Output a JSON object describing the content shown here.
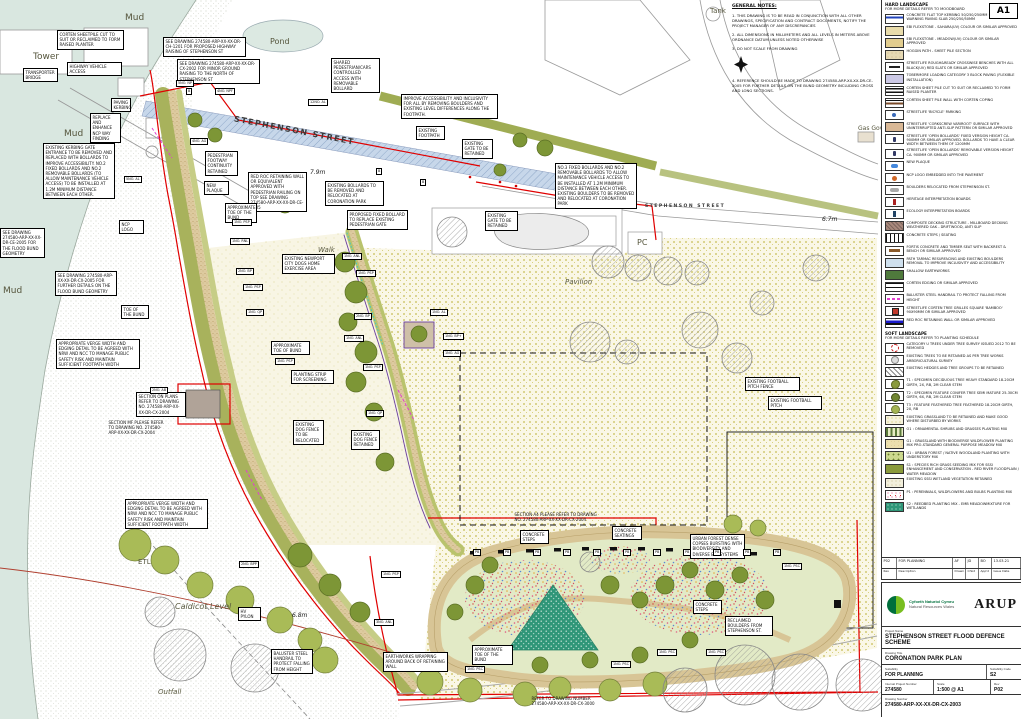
{
  "sheet": {
    "size_tag": "A1"
  },
  "general_notes": {
    "title": "GENERAL NOTES:",
    "items": [
      "1. THIS DRAWING IS TO BE READ IN CONJUNCTION WITH ALL OTHER DRAWINGS, SPECIFICATION AND CONTRACT DOCUMENTS, NOTIFY THE PROJECT MANAGER OF ANY DISCREPANCIES",
      "2. ALL DIMENSIONS IN MILLIMETERS AND ALL LEVELS IN METERS ABOVE ORDNANCE DATUM UNLESS NOTED OTHERWISE",
      "3. DO NOT SCALE FROM DRAWING",
      "4. REFERENCE SHOULD BE MADE TO DRAWING 274580-ARP-XX-XX-DR-CE-2005 FOR FURTHER DETAILS ON THE BUND GEOMETRY INCLUDING CROSS AND LONG SECTIONS."
    ]
  },
  "legend": {
    "hard": {
      "title": "HARD LANDSCAPE",
      "subtitle": "FOR MORE DETAILS REFER TO MOODBOARD",
      "items": [
        {
          "sw": "kerb",
          "label": "CONCRETE FLAT TOP KERBING 50/250/250mm + HAZARD WARNING PAVING SLAB 250/250/50mm"
        },
        {
          "sw": "sahara",
          "label": "EBI FLEXSTONE - SAHARA(UV) COLOUR OR SIMILAR APPROVED"
        },
        {
          "sw": "meadow",
          "label": "EBI FLEXSTONE - MEADOW(UV) COLOUR OR SIMILAR APPROVED"
        },
        {
          "sw": "hoggin",
          "label": "HOGGIN PATH - SHEET PILE SECTION"
        },
        {
          "sw": "bench",
          "label": "STREETLIFE ROUGH&READY CROSSWISE BENCHES WITH ALL BLACK(UV) RED SLATS OR SIMILAR APPROVED"
        },
        {
          "sw": "block-paving",
          "label": "TOBERMORE LOADING CATEGORY 3 BLOCK PAVING (FLEXIBLE INSTALLATION)"
        },
        {
          "sw": "corten-cut",
          "label": "CORTEN SHEET PILE CUT TO SUIT OR RECLAIMED TO FORM RAISED PLANTER"
        },
        {
          "sw": "corten-wall",
          "label": "CORTEN SHEET PILE WALL WITH CORTEN COPING"
        },
        {
          "sw": "bike",
          "label": "STREETLIFE 'BICYCLE' PARKING"
        },
        {
          "sw": "varicoot",
          "label": "STREETLIFE 'CORKSCREW VARIROOT' SURFACE WITH UNINTERRUPTED ANTI-SLIP PATTERN OR SIMILAR APPROVED"
        },
        {
          "sw": "bollard-fixed",
          "label": "STREETLIFE 'OPEN BOLLARDS' FIXED VERSION HEIGHT CA. 900MM OR SIMILAR APPROVED. BOLLARDS TO HAVE A CLEAR WIDTH BETWEEN THEM OF 1200MM"
        },
        {
          "sw": "bollard-removable",
          "label": "STREETLIFE 'OPEN BOLLARDS' REMOVABLE VERSION HEIGHT CA. 900MM OR SIMILAR APPROVED"
        },
        {
          "sw": "plaque",
          "label": "NEW PLAQUE"
        },
        {
          "sw": "ncp",
          "label": "NCP LOGO EMBEDDED INTO THE PAVEMENT"
        },
        {
          "sw": "boulders",
          "label": "BOULDERS RELOCATED FROM STEPHENSON ST."
        },
        {
          "sw": "heritage",
          "label": "HERITAGE INTERPRETATION BOARDS"
        },
        {
          "sw": "ecology",
          "label": "ECOLOGY INTERPRETATION BOARDS"
        },
        {
          "sw": "decking",
          "label": "COMPOSITE DECKING STRUCTURE - MILLBOARD DECKING WEATHERED OAK - DRIFTWOOD, ANTI SLIP"
        },
        {
          "sw": "steps",
          "label": "CONCRETE STEPS / SEATING"
        },
        {
          "sw": "fortis",
          "label": "FORTIS CONCRETE AND TIMBER SEAT WITH BACKREST & BENCH OR SIMILAR APPROVED"
        },
        {
          "sw": "tarmac",
          "label": "PATH TARMAC RESURFACING AND EXISTING BOULDERS REMOVAL TO IMPROVE INCLUSIVITY AND ACCESSIBILITY"
        },
        {
          "sw": "earthworks",
          "label": "SHALLOW EARTHWORKS"
        },
        {
          "sw": "corten-edge",
          "label": "CORTEN EDGING OR SIMILAR APPROVED"
        },
        {
          "sw": "handrail",
          "label": "BALUSTER STEEL HANDRAIL TO PROTECT FALLING FROM HEIGHT"
        },
        {
          "sw": "tree-grille",
          "label": "STREETLIFE CORTEN TREE GRILLES SQUARE 'BAMBOO' 90X90MM OR SIMILAR APPROVED"
        },
        {
          "sw": "redroc",
          "label": "RED ROC RETAINING WALL OR SIMILAR APPROVED"
        }
      ]
    },
    "soft": {
      "title": "SOFT LANDSCAPE",
      "subtitle": "FOR MORE DETAILS REFER TO PLANTING SCHEDULE",
      "items": [
        {
          "sw": "cat-u",
          "label": "CATEGORY U TREES UNDER TREE SURVEY ISSUED 2012 TO BE REMOVED"
        },
        {
          "sw": "exist-tree",
          "label": "EXISTING TREES TO BE RETAINED AS PER TREE WORKS ARBORICULTURAL SURVEY"
        },
        {
          "sw": "hedges",
          "label": "EXISTING HEDGES AND TREE GROUPS TO BE RETAINED"
        },
        {
          "sw": "t1",
          "label": "T1 : SPECIMEN DECIDUOUS TREE HEAVY STANDARD 18-20CM GIRTH, 2X, RB, 2M CLEAR STEM"
        },
        {
          "sw": "t2",
          "label": "T2 : SPECIMEN FEATURE CONIFER TREE SEMI MATURE 25-30CM GIRTH, 6X, RB, 2M CLEAR STEM"
        },
        {
          "sw": "t3",
          "label": "T3 : FEATURE FEATHERED TREE FEATHERED 18-20CM GIRTH, 2X, RB"
        },
        {
          "sw": "grass-exist",
          "label": "EXISTING GRASSLAND TO BE RETAINED AND MAKE GOOD WHERE DISTURBED BY WORKS"
        },
        {
          "sw": "o1",
          "label": "O1 : ORNAMENTAL SHRUBS AND GRASSES PLANTING MIX"
        },
        {
          "sw": "g1",
          "label": "G1 : GRASSLAND WITH BIODIVERSE WILDFLOWER PLANTING MIX PRO-STANDARD GENERAL PURPOSE MEADOW MIX"
        },
        {
          "sw": "u1",
          "label": "U1 : URBAN FOREST / NATIVE WOODLAND PLANTING WITH UNDERSTORY MIX"
        },
        {
          "sw": "s1",
          "label": "S1 : SPECIES RICH GRASS SEEDING MIX FOR SSSI ENHANCEMENT AND CONSERVATION - RED RIVER FLOODPLAIN / WATER MEADOW"
        },
        {
          "sw": "sssi",
          "label": "EXISTING SSSI WETLAND VEGETATION RETAINED"
        },
        {
          "sw": "p1",
          "label": "P1 : PERENNIALS, WILDFLOWERS AND BULBS PLANTING MIX"
        },
        {
          "sw": "s2",
          "label": "S2 : REEDBED PLANTING MIX - EMB MEADOWMIXTURE FOR WETLANDS"
        }
      ]
    }
  },
  "revision_table": {
    "headers": [
      "Rev",
      "Description",
      "Drawn",
      "Chkd",
      "App'd",
      "Issue Date"
    ],
    "rows": [
      [
        "P02",
        "FOR PLANNING",
        "AF",
        "JD",
        "BO",
        "13.03.21"
      ]
    ]
  },
  "title_block": {
    "client_line1": "Cyfoeth Naturiol Cymru",
    "client_line2": "Natural Resources Wales",
    "consultant": "ARUP",
    "project_name_label": "Project Name",
    "project_name": "STEPHENSON STREET FLOOD DEFENCE SCHEME",
    "drawing_title_label": "Drawing Title",
    "drawing_title": "CORONATION PARK PLAN",
    "suitability_label": "Suitability",
    "suitability": "FOR PLANNING",
    "suitability_code_label": "Suitability Code",
    "suitability_code": "S2",
    "project_number_label": "Internal Project Number",
    "project_number": "274580",
    "scale_label": "Scale",
    "scale": "1:500 @ A1",
    "rev_label": "Rev",
    "rev": "P02",
    "drawing_number_label": "Drawing Number",
    "drawing_number": "274580-ARP-XX-XX-DR-CX-2003"
  },
  "map": {
    "annotations": [
      {
        "t": "CORTEN SHEETPILE CUT TO SUIT OR RECLAIMED TO FORM RAISED PLANTER",
        "x": 57,
        "y": 30,
        "w": 62
      },
      {
        "t": "SEE DRAWING 274580-ARP-XX-XX-DR-CH-1201 FOR PROPOSED HIGHWAY RAISING OF STEPHENSON ST",
        "x": 163,
        "y": 37,
        "w": 78
      },
      {
        "t": "SEE DRAWING 274580-ARP-XX-XX-DR-CX-2002 FOR MINOR GROUND RAISING TO THE NORTH OF STEPHENSON ST",
        "x": 177,
        "y": 59,
        "w": 78
      },
      {
        "t": "SHARED PEDESTRIAN/CARS CONTROLLED ACCESS WITH REMOVABLE BOLLARD",
        "x": 331,
        "y": 58,
        "w": 44
      },
      {
        "t": "HIGHWAY VEHICLE ACCESS",
        "x": 67,
        "y": 62,
        "w": 50
      },
      {
        "t": "TRANSPORTER BRIDGE",
        "x": 23,
        "y": 68,
        "w": 30
      },
      {
        "t": "PAVING KERBING",
        "x": 111,
        "y": 98,
        "w": 15
      },
      {
        "t": "REPLACE AND ENHANCE NCP WAY FINDING",
        "x": 90,
        "y": 113,
        "w": 26
      },
      {
        "t": "IMPROVE ACCESSIBILITY AND INCLUSIVITY FOR ALL BY REMOVING BOULDERS AND EXISTING LEVEL DIFFERENCES ALONG THE FOOTPATH.",
        "x": 401,
        "y": 94,
        "w": 92
      },
      {
        "t": "EXISTING KERBING GATE ENTRANCE TO BE REMOVED AND REPLACED WITH BOLLARDS TO IMPROVE ACCESSIBILITY. NO.2 FIXED BOLLARDS AND NO.2 REMOVABLE BOLLARDS (TO ALLOW MAINTENANCE VEHICLE ACCESS) TO BE INSTALLED AT 1.2M MINIMUM DISTANCE BETWEEN EACH OTHER.",
        "x": 43,
        "y": 143,
        "w": 67
      },
      {
        "t": "RED ROC RETAINING WALL OR EQUIVALENT APPROVED WITH PEDESTRIAN RAILING ON TOP SEE DRAWING 274580-ARP-XX-XX-DR-CE-2005",
        "x": 248,
        "y": 172,
        "w": 54
      },
      {
        "t": "PEDESTRIAN FOOTWAY CONTINUITY RETAINED",
        "x": 205,
        "y": 151,
        "w": 28
      },
      {
        "t": "NEW PLAQUE",
        "x": 204,
        "y": 181,
        "w": 20
      },
      {
        "t": "EXISTING FOOTPATH",
        "x": 416,
        "y": 126,
        "w": 24
      },
      {
        "t": "EXISTING GATE TO BE RETAINED",
        "x": 462,
        "y": 139,
        "w": 26
      },
      {
        "t": "EXISTING BOLLARDS TO BE REMOVED AND RELOCATED AT CORONATION PARK",
        "x": 325,
        "y": 181,
        "w": 54
      },
      {
        "t": "PROPOSED FIXED BOLLARD TO REPLACE EXISTING PEDESTRIAN GATE",
        "x": 347,
        "y": 210,
        "w": 56
      },
      {
        "t": "NO.3 FIXED BOLLARDS AND NO.2 REMOVABLE BOLLARDS TO ALLOW MAINTENANCE VEHICLE ACCESS TO BE INSTALLED AT 1.2M MINIMUM DISTANCE BETWEEN EACH OTHER. EXISTING BOULDERS TO BE REMOVED AND RELOCATED AT CORONATION PARK",
        "x": 555,
        "y": 163,
        "w": 77
      },
      {
        "t": "EXISTING GATE TO BE RETAINED",
        "x": 485,
        "y": 211,
        "w": 28
      },
      {
        "t": "EXISTING NEWPORT CITY DOGS HOME EXERCISE AREA",
        "x": 282,
        "y": 254,
        "w": 48
      },
      {
        "t": "SEE DRAWING 274580-ARP-XX-XX-DR-CE-2005 FOR THE FLOOD BUND GEOMETRY",
        "x": 0,
        "y": 228,
        "w": 40
      },
      {
        "t": "SEE DRAWING 274580-ARP-XX-XX-DR-CX-2005 FOR FURTHER DETAILS ON THE FLOOD BUND GEOMETRY",
        "x": 55,
        "y": 271,
        "w": 57
      },
      {
        "t": "NCP LOGO",
        "x": 119,
        "y": 220,
        "w": 20
      },
      {
        "t": "APPROXIMATE TOE OF THE BUND",
        "x": 225,
        "y": 203,
        "w": 27
      },
      {
        "t": "TOE OF THE BUND",
        "x": 121,
        "y": 305,
        "w": 23
      },
      {
        "t": "APPROPRIATE VERGE WIDTH AND EDGING DETAIL TO BE AGREED WITH NRW AND NCC TO MANAGE PUBLIC SAFETY RISK AND MAINTAIN SUFFICIENT FOOTPATH WIDTH",
        "x": 56,
        "y": 339,
        "w": 79
      },
      {
        "t": "SECTION ON PLANS REFER TO DRAWING NO. 274580-ARP-XX-XX-DR-CX-2004",
        "x": 136,
        "y": 392,
        "w": 45
      },
      {
        "t": "EXISTING DOG FENCE TO BE RELOCATED",
        "x": 293,
        "y": 420,
        "w": 26
      },
      {
        "t": "EXISTING DOG FENCE RETAINED",
        "x": 351,
        "y": 430,
        "w": 24
      },
      {
        "t": "PLANTING STRIP FOR SCREENING",
        "x": 291,
        "y": 370,
        "w": 38
      },
      {
        "t": "APPROXIMATE TOE OF BUND",
        "x": 271,
        "y": 341,
        "w": 34
      },
      {
        "t": "SECTION MF PLEASE REFER TO DRAWING NO. 274580-ARP-XX-XX-DR-CX-2004",
        "x": 107,
        "y": 419,
        "w": 56,
        "plain": true
      },
      {
        "t": "APPROPRIATE VERGE WIDTH AND EDGING DETAIL TO BE AGREED WITH NRW AND NCC TO MANAGE PUBLIC SAFETY RISK AND MAINTAIN SUFFICIENT FOOTPATH WIDTH",
        "x": 125,
        "y": 499,
        "w": 78
      },
      {
        "t": "EXISTING FOOTBALL PITCH FENCE",
        "x": 745,
        "y": 377,
        "w": 50
      },
      {
        "t": "EXISTING FOOTBALL PITCH",
        "x": 768,
        "y": 396,
        "w": 49
      },
      {
        "t": "SECTION A4 PLEASE REFER TO DRAWING NO. 274580-ARP-XX-XX-DR-CX-2004",
        "x": 513,
        "y": 511,
        "w": 84,
        "plain": true
      },
      {
        "t": "CONCRETE STEPS",
        "x": 520,
        "y": 530,
        "w": 24
      },
      {
        "t": "CONCRETE SEATINGS",
        "x": 612,
        "y": 526,
        "w": 25
      },
      {
        "t": "URBAN FOREST DENSE COPSES BURSTING WITH BIODIVERSITY AND DIVERSE ECOSYSTEMS",
        "x": 690,
        "y": 534,
        "w": 50
      },
      {
        "t": "CONCRETE STEPS",
        "x": 693,
        "y": 600,
        "w": 24
      },
      {
        "t": "RECLAIMED BOULDERS FROM STEPHENSON ST.",
        "x": 725,
        "y": 616,
        "w": 43
      },
      {
        "t": "APPROXIMATE TOE OF THE BUND",
        "x": 472,
        "y": 645,
        "w": 36
      },
      {
        "t": "BALUSTER STEEL HANDRAIL TO PROTECT FALLING FROM HEIGHT",
        "x": 271,
        "y": 649,
        "w": 37
      },
      {
        "t": "EARTHWORKS WRAPPING AROUND BACK OF RETAINING WALL",
        "x": 383,
        "y": 652,
        "w": 60
      },
      {
        "t": "REFER TO DRAWING NUMBER 274580-ARP-XX-XX-DR-CX-3000",
        "x": 530,
        "y": 695,
        "w": 66,
        "plain": true
      },
      {
        "t": "HV PYLON",
        "x": 238,
        "y": 607,
        "w": 18
      }
    ],
    "tags": [
      {
        "t": "5NO. NP",
        "x": 176,
        "y": 80
      },
      {
        "t": "B",
        "x": 186,
        "y": 88
      },
      {
        "t": "4NO. NPF",
        "x": 215,
        "y": 88
      },
      {
        "t": "4NO. AG",
        "x": 190,
        "y": 138
      },
      {
        "t": "5NO. AL",
        "x": 124,
        "y": 176
      },
      {
        "t": "12NO. AL",
        "x": 308,
        "y": 99
      },
      {
        "t": "B",
        "x": 376,
        "y": 168
      },
      {
        "t": "B",
        "x": 420,
        "y": 179
      },
      {
        "t": "1NO. PSP",
        "x": 232,
        "y": 219
      },
      {
        "t": "1NO. RNL",
        "x": 230,
        "y": 238
      },
      {
        "t": "2NO. BP",
        "x": 236,
        "y": 268
      },
      {
        "t": "1NO. PSP",
        "x": 243,
        "y": 284
      },
      {
        "t": "1NO. QP",
        "x": 246,
        "y": 309
      },
      {
        "t": "1NO. PSP",
        "x": 275,
        "y": 358
      },
      {
        "t": "1NO. ANL",
        "x": 342,
        "y": 253
      },
      {
        "t": "1NO. PSP",
        "x": 356,
        "y": 270
      },
      {
        "t": "2NO. BP",
        "x": 354,
        "y": 313
      },
      {
        "t": "1NO. ANL",
        "x": 344,
        "y": 335
      },
      {
        "t": "1NO. AL",
        "x": 430,
        "y": 309
      },
      {
        "t": "1NO. BP+",
        "x": 443,
        "y": 333
      },
      {
        "t": "1NO. AG",
        "x": 443,
        "y": 350
      },
      {
        "t": "1NO. PSP",
        "x": 363,
        "y": 364
      },
      {
        "t": "1NO. QP",
        "x": 366,
        "y": 410
      },
      {
        "t": "2NO. AB",
        "x": 150,
        "y": 387
      },
      {
        "t": "2NO. BPP",
        "x": 239,
        "y": 561
      },
      {
        "t": "1NO. PSP",
        "x": 381,
        "y": 571
      },
      {
        "t": "3NO. ANL",
        "x": 374,
        "y": 619
      },
      {
        "t": "1NO. PSC",
        "x": 465,
        "y": 666
      },
      {
        "t": "1NO. PSC",
        "x": 611,
        "y": 661
      },
      {
        "t": "1NO. PSC",
        "x": 657,
        "y": 649
      },
      {
        "t": "1NO. PSC",
        "x": 706,
        "y": 649
      },
      {
        "t": "1NO. PSC",
        "x": 782,
        "y": 563
      },
      {
        "t": "PB",
        "x": 473,
        "y": 549
      },
      {
        "t": "PB",
        "x": 503,
        "y": 549
      },
      {
        "t": "PB",
        "x": 533,
        "y": 549
      },
      {
        "t": "PB",
        "x": 563,
        "y": 549
      },
      {
        "t": "PB",
        "x": 593,
        "y": 549
      },
      {
        "t": "PB",
        "x": 623,
        "y": 549
      },
      {
        "t": "PB",
        "x": 653,
        "y": 549
      },
      {
        "t": "PB",
        "x": 683,
        "y": 549
      },
      {
        "t": "PB",
        "x": 713,
        "y": 549
      },
      {
        "t": "PB",
        "x": 743,
        "y": 549
      },
      {
        "t": "PB",
        "x": 773,
        "y": 549
      }
    ],
    "labels": [
      {
        "t": "Tower",
        "x": 33,
        "y": 52,
        "fs": 9,
        "cls": ""
      },
      {
        "t": "Mud",
        "x": 125,
        "y": 13,
        "fs": 9,
        "cls": ""
      },
      {
        "t": "Mud",
        "x": 64,
        "y": 129,
        "fs": 9,
        "cls": ""
      },
      {
        "t": "Mud",
        "x": 3,
        "y": 286,
        "fs": 9,
        "cls": ""
      },
      {
        "t": "Pond",
        "x": 270,
        "y": 37,
        "fs": 8,
        "cls": ""
      },
      {
        "t": "Tank",
        "x": 710,
        "y": 7,
        "fs": 7,
        "cls": ""
      },
      {
        "t": "Gas Gov",
        "x": 858,
        "y": 125,
        "fs": 6,
        "cls": ""
      },
      {
        "t": "STEPHENSON STREET",
        "x": 233,
        "y": 126,
        "fs": 8,
        "cls": "street",
        "rot": 11
      },
      {
        "t": "STEPHENSON STREET",
        "x": 645,
        "y": 204,
        "fs": 4.5,
        "cls": "street"
      },
      {
        "t": "Walk",
        "x": 318,
        "y": 246,
        "fs": 7,
        "cls": "it"
      },
      {
        "t": "Pavilion",
        "x": 565,
        "y": 278,
        "fs": 7,
        "cls": "it"
      },
      {
        "t": "PC",
        "x": 637,
        "y": 238,
        "fs": 8,
        "cls": ""
      },
      {
        "t": "Caldicot Level",
        "x": 175,
        "y": 602,
        "fs": 8,
        "cls": "it"
      },
      {
        "t": "Outfall",
        "x": 158,
        "y": 688,
        "fs": 7,
        "cls": "it"
      },
      {
        "t": "ETL",
        "x": 138,
        "y": 558,
        "fs": 7,
        "cls": ""
      },
      {
        "t": "7.9m",
        "x": 310,
        "y": 169,
        "fs": 6,
        "cls": "dim"
      },
      {
        "t": "6.7m",
        "x": 822,
        "y": 216,
        "fs": 6,
        "cls": "dim"
      },
      {
        "t": "6.8m",
        "x": 292,
        "y": 612,
        "fs": 6,
        "cls": "dim"
      }
    ]
  }
}
